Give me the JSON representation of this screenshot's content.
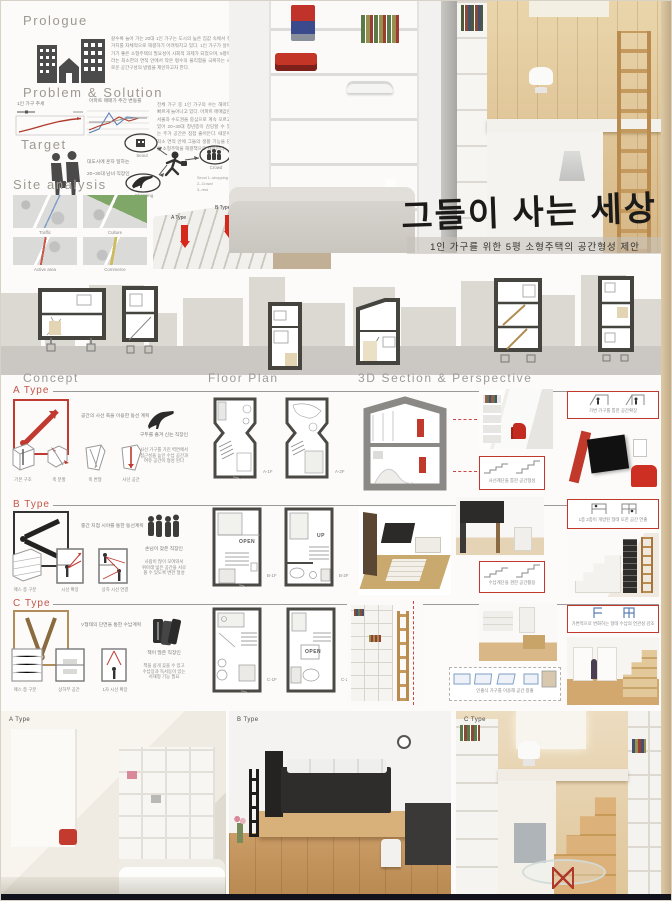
{
  "board": {
    "title": "그들이 사는 세상",
    "subtitle": "1인 가구를 위한 5평 소형주택의 공간형성 제안"
  },
  "prologue": {
    "heading": "Prologue",
    "text": "갈수록 늘어 가는 20대 1인 가구는 도시의 높은 집값 속에서 주거지를 자체적으로 해결하기 어려워지고 있다. 1인 가구가 살아가기 좋은 소형주택의 필요성이 사회적 과제가 되었으며, 5평이라는 최소한의 면적 안에서 작은 평수의 불리함을 극복하는 새로운 공간구성의 방법을 제안하고자 한다."
  },
  "problem": {
    "heading": "Problem & Solution",
    "chart1_title": "1인 가구 추세",
    "chart2_title": "아파트 매매가 주간 변동률",
    "text": "전체 가구 중 1인 가구의 수는 해마다 빠르게 늘어나고 있다. 아파트 매매값은 서울과 수도권을 중심으로 계속 오르고 있어 20~30대 청년층이 감당할 수 있는 주거 공간은 점점 줄어든다. 때문에 최소 면적 안에 그들의 생활 기능을 담은 소형주택을 해결책으로 제안한다."
  },
  "target": {
    "heading": "Target",
    "line1": "대도시에 혼자 일하는",
    "line2": "20~30대 남녀 직장인",
    "nodes": [
      "Seoul",
      "Crowd",
      "Shopping"
    ],
    "legend": [
      "Seoul 1--shopping",
      "2--Crowd",
      "3--rest"
    ]
  },
  "site": {
    "heading": "Site analysis",
    "maps": [
      "Traffic",
      "Culture",
      "Active area",
      "Commerce"
    ],
    "arrows": [
      "A Type",
      "B Type",
      "C Type"
    ],
    "note": "대구 달서구\n단독주택 밀집지역 대상지"
  },
  "columns": {
    "concept": "Concept",
    "floor_plan": "Floor Plan",
    "perspective": "3D Section & Perspective"
  },
  "types": [
    {
      "label": "A Type",
      "concept_caption": "공간의 사선 축을 이용한 동선 계획",
      "steps": [
        "기본 구조",
        "축 분할",
        "축 변형",
        "사선 공간"
      ],
      "persona_caption": "구두를 즐겨 신는 직장인",
      "persona_text": "사선 가구를 가진 벽면에서\n접근성을 높인 수납 공간과\n여유 공간이 형성 된다",
      "plans": [
        "A-1F",
        "A-2F"
      ],
      "callout_top": "가변 가구를 통한 공간확장",
      "callout_bottom": "사선계단을 통한 공간형성"
    },
    {
      "label": "B Type",
      "concept_caption": "중간 지점 시야를 통한 동선계획",
      "steps": [
        "매스 층 구분",
        "시선 확장",
        "상하 시선 연결"
      ],
      "persona_caption": "손님이 잦은 직장인",
      "persona_text": "사람이 많이 모여와서\n위아래 넓은 공간을 서로\n볼 수 있도록 변한 형성",
      "plans": [
        "B-1F",
        "B-2F"
      ],
      "plan_tags": [
        "OPEN",
        "UP"
      ],
      "callout_top": "1층 2층이 개방된 형태 또한 공간 연출",
      "callout_bottom": "수납계단을 겸한 공간활용"
    },
    {
      "label": "C Type",
      "concept_caption": "V형태의 단면을 통한 수납계획",
      "steps": [
        "매스 층 구분",
        "상하부 공간",
        "1자 시선 확장"
      ],
      "persona_caption": "책이 많은 직장인",
      "persona_text": "책을 쉽게 꽂을 수 있고\n수납장과 독서등이 있는\n서재형 기능 필요",
      "plans": [
        "C-1F",
        "C-2F"
      ],
      "plan_tags": [
        "OPEN"
      ],
      "callout_top": "가변적으로 변화하는 형태 수납의 연관성 강조",
      "callout_bottom": "인출식 가구를 이용해 공간 창출"
    }
  ],
  "renders": {
    "a": "A Type",
    "b": "B Type",
    "c": "C Type"
  },
  "colors": {
    "accent_red": "#c0392b",
    "type_label": "#c4554a",
    "tan": "#c9ad85",
    "footer": "#12121c"
  },
  "chart_data": [
    {
      "type": "line",
      "title": "1인 가구 추세",
      "x": [
        1,
        2,
        3,
        4,
        5,
        6
      ],
      "series": [
        {
          "name": "1인 가구",
          "values": [
            2,
            3,
            4.5,
            6,
            7,
            7.5
          ]
        }
      ],
      "ylim": [
        0,
        10
      ],
      "grid": false
    },
    {
      "type": "line",
      "title": "아파트 매매가 주간 변동률",
      "x": [
        1,
        2,
        3,
        4,
        5,
        6,
        7
      ],
      "series": [
        {
          "name": "series-blue",
          "values": [
            1,
            2,
            6,
            3,
            5,
            5,
            5
          ]
        },
        {
          "name": "series-red",
          "values": [
            2,
            3,
            4,
            5,
            4,
            5,
            5
          ]
        },
        {
          "name": "series-gray",
          "values": [
            4,
            4,
            4,
            5,
            5,
            5,
            5
          ]
        }
      ],
      "ylim": [
        0,
        8
      ],
      "grid": true
    }
  ]
}
